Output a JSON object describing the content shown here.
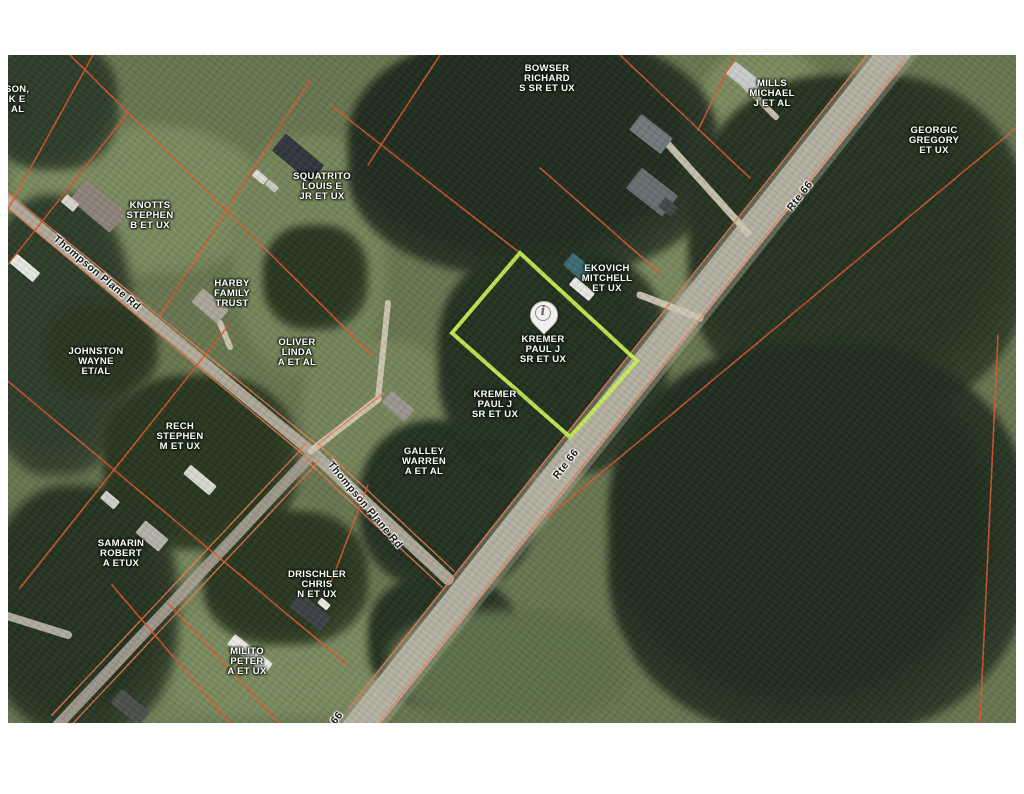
{
  "map": {
    "x": 8,
    "y": 55,
    "width": 1008,
    "height": 668,
    "colors": {
      "page_background": "#ffffff",
      "base_grass": "#67754f",
      "forest_dark": "#1f2c1e",
      "forest_mid": "#2c3b28",
      "lawn_light": "#7a8a5e",
      "parcel_line": "#e2572f",
      "road_edge_line": "#ef7a52",
      "highlight_outline": "#c6ed53",
      "road_fill": "#c6c1b4",
      "pin_fill": "#f2f0ec"
    },
    "owner_labels": [
      {
        "id": "johnson-partial",
        "lines": [
          "HNSON,",
          "ARK E",
          "ET AL"
        ],
        "x": 2,
        "y": 45
      },
      {
        "id": "knotts",
        "lines": [
          "KNOTTS",
          "STEPHEN",
          "B ET UX"
        ],
        "x": 142,
        "y": 161
      },
      {
        "id": "bowser",
        "lines": [
          "BOWSER",
          "RICHARD",
          "S SR ET UX"
        ],
        "x": 539,
        "y": 24
      },
      {
        "id": "mills",
        "lines": [
          "MILLS",
          "MICHAEL",
          "J ET AL"
        ],
        "x": 764,
        "y": 39
      },
      {
        "id": "georgic",
        "lines": [
          "GEORGIC",
          "GREGORY",
          "ET UX"
        ],
        "x": 926,
        "y": 86
      },
      {
        "id": "squatrito",
        "lines": [
          "SQUATRITO",
          "LOUIS E",
          "JR ET UX"
        ],
        "x": 314,
        "y": 132
      },
      {
        "id": "harby",
        "lines": [
          "HARBY",
          "FAMILY",
          "TRUST"
        ],
        "x": 224,
        "y": 239
      },
      {
        "id": "ekovich",
        "lines": [
          "EKOVICH",
          "MITCHELL",
          "ET UX"
        ],
        "x": 599,
        "y": 224
      },
      {
        "id": "kremer-pin",
        "lines": [
          "KREMER",
          "PAUL J",
          "SR ET UX"
        ],
        "x": 535,
        "y": 295
      },
      {
        "id": "kremer-2",
        "lines": [
          "KREMER",
          "PAUL J",
          "SR ET UX"
        ],
        "x": 487,
        "y": 350
      },
      {
        "id": "oliver",
        "lines": [
          "OLIVER",
          "LINDA",
          "A ET AL"
        ],
        "x": 289,
        "y": 298
      },
      {
        "id": "johnston",
        "lines": [
          "JOHNSTON",
          "WAYNE",
          "ET/AL"
        ],
        "x": 88,
        "y": 307
      },
      {
        "id": "rech",
        "lines": [
          "RECH",
          "STEPHEN",
          "M ET UX"
        ],
        "x": 172,
        "y": 382
      },
      {
        "id": "galley",
        "lines": [
          "GALLEY",
          "WARREN",
          "A ET AL"
        ],
        "x": 416,
        "y": 407
      },
      {
        "id": "samarin",
        "lines": [
          "SAMARIN",
          "ROBERT",
          "A ETUX"
        ],
        "x": 113,
        "y": 499
      },
      {
        "id": "drischler",
        "lines": [
          "DRISCHLER",
          "CHRIS",
          "N ET UX"
        ],
        "x": 309,
        "y": 530
      },
      {
        "id": "milito",
        "lines": [
          "MILITO",
          "PETER",
          "A ET UX"
        ],
        "x": 239,
        "y": 607
      }
    ],
    "road_labels": [
      {
        "id": "rte66-top",
        "text": "Rte 66",
        "x": 792,
        "y": 141,
        "rotation": -52
      },
      {
        "id": "rte66-mid",
        "text": "Rte 66",
        "x": 558,
        "y": 409,
        "rotation": -52
      },
      {
        "id": "rte66-partial",
        "text": "66",
        "x": 329,
        "y": 663,
        "rotation": -52
      },
      {
        "id": "thompson-plane-rd-1",
        "text": "Thompson Plane Rd",
        "x": 89,
        "y": 218,
        "rotation": 40
      },
      {
        "id": "thompson-plane-rd-2",
        "text": "Thompson Plane Rd",
        "x": 357,
        "y": 450,
        "rotation": 50
      }
    ],
    "highlight_parcel": {
      "owner": "KREMER PAUL J SR ET UX",
      "points": [
        [
          512,
          198
        ],
        [
          629,
          306
        ],
        [
          562,
          382
        ],
        [
          444,
          278
        ]
      ]
    },
    "pin": {
      "x": 535,
      "y": 277,
      "glyph": "i"
    },
    "roads": [
      {
        "id": "rte-66",
        "pts": [
          [
            904,
            -25
          ],
          [
            334,
            693
          ]
        ],
        "w": 30,
        "color": "#c6c1b4"
      },
      {
        "id": "rte-66-shoulder",
        "pts": [
          [
            904,
            -25
          ],
          [
            334,
            693
          ]
        ],
        "w": 40,
        "color": "#a9a593"
      },
      {
        "id": "thompson-upper",
        "pts": [
          [
            -10,
            138
          ],
          [
            305,
            398
          ]
        ],
        "w": 11,
        "color": "#b5ae9e"
      },
      {
        "id": "thompson-lower",
        "pts": [
          [
            305,
            398
          ],
          [
            440,
            524
          ]
        ],
        "w": 12,
        "color": "#b5ae9e"
      },
      {
        "id": "branch-southwest",
        "pts": [
          [
            305,
            398
          ],
          [
            50,
            670
          ]
        ],
        "w": 11,
        "color": "#a39d8f"
      },
      {
        "id": "stub-northeast",
        "pts": [
          [
            303,
            396
          ],
          [
            370,
            344
          ]
        ],
        "w": 7,
        "color": "#d0c8b4"
      },
      {
        "id": "oliver-driveway",
        "pts": [
          [
            370,
            344
          ],
          [
            380,
            248
          ]
        ],
        "w": 6,
        "color": "#d0c8b4"
      },
      {
        "id": "ekovich-driveway",
        "pts": [
          [
            632,
            240
          ],
          [
            692,
            263
          ]
        ],
        "w": 7,
        "color": "#d0c8b4"
      },
      {
        "id": "bowser-driveway",
        "pts": [
          [
            650,
            78
          ],
          [
            740,
            178
          ]
        ],
        "w": 7,
        "color": "#cfc7b2"
      },
      {
        "id": "mills-driveway",
        "pts": [
          [
            736,
            30
          ],
          [
            768,
            62
          ]
        ],
        "w": 6,
        "color": "#cfc7b2"
      },
      {
        "id": "harby-driveway",
        "pts": [
          [
            212,
            268
          ],
          [
            222,
            292
          ]
        ],
        "w": 6,
        "color": "#cfc7b2"
      },
      {
        "id": "west-spur",
        "pts": [
          [
            60,
            580
          ],
          [
            -10,
            558
          ]
        ],
        "w": 8,
        "color": "#b8b2a4"
      }
    ],
    "road_edge_lines": [
      [
        871,
        -15,
        341,
        653
      ],
      [
        897,
        5,
        367,
        673
      ],
      [
        -10,
        130,
        307,
        388
      ],
      [
        -6,
        148,
        303,
        406
      ],
      [
        311,
        390,
        446,
        516
      ],
      [
        299,
        406,
        434,
        532
      ],
      [
        299,
        388,
        44,
        660
      ],
      [
        311,
        406,
        56,
        678
      ],
      [
        309,
        390,
        376,
        338
      ]
    ],
    "parcel_lines": [
      [
        52,
        -10,
        364,
        300
      ],
      [
        85,
        0,
        -10,
        172
      ],
      [
        120,
        58,
        -10,
        222
      ],
      [
        302,
        25,
        152,
        260
      ],
      [
        221,
        270,
        12,
        533
      ],
      [
        -10,
        318,
        340,
        610
      ],
      [
        322,
        50,
        512,
        198
      ],
      [
        612,
        0,
        742,
        123
      ],
      [
        532,
        113,
        652,
        218
      ],
      [
        727,
        0,
        690,
        75
      ],
      [
        1008,
        73,
        540,
        462
      ],
      [
        990,
        280,
        972,
        668
      ],
      [
        432,
        0,
        360,
        110
      ],
      [
        360,
        430,
        322,
        530
      ],
      [
        160,
        548,
        275,
        672
      ],
      [
        104,
        530,
        222,
        668
      ]
    ],
    "buildings": [
      {
        "id": "knotts-house",
        "cx": 90,
        "cy": 151,
        "w": 52,
        "h": 26,
        "rot": 40,
        "color": "#8f837b"
      },
      {
        "id": "knotts-pad",
        "cx": 62,
        "cy": 148,
        "w": 16,
        "h": 10,
        "rot": 40,
        "color": "#d8d5cc"
      },
      {
        "id": "squatrito-house",
        "cx": 290,
        "cy": 103,
        "w": 50,
        "h": 22,
        "rot": 40,
        "color": "#30353b"
      },
      {
        "id": "squatrito-car-1",
        "cx": 252,
        "cy": 122,
        "w": 15,
        "h": 8,
        "rot": 40,
        "color": "#dddcd6"
      },
      {
        "id": "squatrito-car-2",
        "cx": 264,
        "cy": 131,
        "w": 13,
        "h": 7,
        "rot": 40,
        "color": "#c9c9c3"
      },
      {
        "id": "bowser-house-1",
        "cx": 643,
        "cy": 79,
        "w": 40,
        "h": 20,
        "rot": 38,
        "color": "#70787a"
      },
      {
        "id": "bowser-house-2",
        "cx": 644,
        "cy": 137,
        "w": 46,
        "h": 26,
        "rot": 38,
        "color": "#666d70"
      },
      {
        "id": "bowser-house-2-wing",
        "cx": 660,
        "cy": 152,
        "w": 16,
        "h": 12,
        "rot": 38,
        "color": "#3f4649"
      },
      {
        "id": "mills-house",
        "cx": 736,
        "cy": 23,
        "w": 34,
        "h": 16,
        "rot": 38,
        "color": "#c9ccca"
      },
      {
        "id": "ekovich-house",
        "cx": 570,
        "cy": 212,
        "w": 26,
        "h": 16,
        "rot": 40,
        "color": "#3c6a72"
      },
      {
        "id": "ekovich-trailer",
        "cx": 574,
        "cy": 234,
        "w": 26,
        "h": 10,
        "rot": 40,
        "color": "#e9e9e5"
      },
      {
        "id": "oliver-house",
        "cx": 390,
        "cy": 351,
        "w": 30,
        "h": 16,
        "rot": 40,
        "color": "#9b978f"
      },
      {
        "id": "harby-house",
        "cx": 202,
        "cy": 251,
        "w": 34,
        "h": 18,
        "rot": 40,
        "color": "#aba59b"
      },
      {
        "id": "johnston-trailer",
        "cx": 17,
        "cy": 213,
        "w": 30,
        "h": 12,
        "rot": 40,
        "color": "#e7e7e3"
      },
      {
        "id": "rech-mobile-home",
        "cx": 192,
        "cy": 425,
        "w": 34,
        "h": 12,
        "rot": 40,
        "color": "#d9d9d3"
      },
      {
        "id": "shed",
        "cx": 102,
        "cy": 445,
        "w": 18,
        "h": 10,
        "rot": 40,
        "color": "#d0d0c9"
      },
      {
        "id": "samarin-house",
        "cx": 144,
        "cy": 481,
        "w": 30,
        "h": 16,
        "rot": 40,
        "color": "#b7b3a9"
      },
      {
        "id": "drischler-house",
        "cx": 302,
        "cy": 557,
        "w": 40,
        "h": 18,
        "rot": 40,
        "color": "#3b4042"
      },
      {
        "id": "drischler-house-white",
        "cx": 316,
        "cy": 549,
        "w": 12,
        "h": 7,
        "rot": 40,
        "color": "#eaeae6"
      },
      {
        "id": "milito-trailer",
        "cx": 242,
        "cy": 599,
        "w": 48,
        "h": 13,
        "rot": 38,
        "color": "#edece6"
      },
      {
        "id": "southwest-house",
        "cx": 122,
        "cy": 652,
        "w": 36,
        "h": 18,
        "rot": 40,
        "color": "#4b4f4b"
      }
    ],
    "terrain": [
      {
        "id": "lawn-knotts",
        "x": 0,
        "y": 70,
        "w": 255,
        "h": 150,
        "color": "#7a8a5e",
        "blur": 5
      },
      {
        "id": "lawn-squatrito-harby",
        "x": 225,
        "y": 80,
        "w": 155,
        "h": 240,
        "color": "#75855a",
        "blur": 5
      },
      {
        "id": "lawn-bowser-east",
        "x": 565,
        "y": 25,
        "w": 130,
        "h": 170,
        "color": "#7a8a5e",
        "blur": 5
      },
      {
        "id": "lawn-roadside-ne",
        "x": 630,
        "y": 120,
        "w": 130,
        "h": 150,
        "color": "#75855a",
        "blur": 5
      },
      {
        "id": "lawn-mills",
        "x": 692,
        "y": -5,
        "w": 130,
        "h": 115,
        "color": "#7a8a5e",
        "blur": 5
      },
      {
        "id": "lawn-oliver",
        "x": 295,
        "y": 285,
        "w": 150,
        "h": 135,
        "color": "#75855a",
        "blur": 5
      },
      {
        "id": "lawn-ekovich",
        "x": 545,
        "y": 135,
        "w": 140,
        "h": 115,
        "color": "#78885c",
        "blur": 5
      },
      {
        "id": "field-southwest",
        "x": 0,
        "y": 420,
        "w": 340,
        "h": 250,
        "color": "#74855c",
        "blur": 6
      },
      {
        "id": "field-milito",
        "x": 150,
        "y": 545,
        "w": 265,
        "h": 120,
        "color": "#7a8a5e",
        "blur": 6
      },
      {
        "id": "forest-top-center",
        "x": 340,
        "y": -20,
        "w": 370,
        "h": 240,
        "color": "#1f2c1e",
        "blur": 4
      },
      {
        "id": "forest-right-upper",
        "x": 680,
        "y": 20,
        "w": 340,
        "h": 340,
        "color": "#24321f",
        "blur": 4
      },
      {
        "id": "forest-right-lower",
        "x": 600,
        "y": 290,
        "w": 420,
        "h": 390,
        "color": "#1f2c1e",
        "blur": 4
      },
      {
        "id": "forest-galley",
        "x": 352,
        "y": 365,
        "w": 175,
        "h": 170,
        "color": "#22301f",
        "blur": 4
      },
      {
        "id": "forest-kremer",
        "x": 430,
        "y": 190,
        "w": 230,
        "h": 230,
        "color": "#22301f",
        "blur": 4
      },
      {
        "id": "forest-topleft-corner",
        "x": -20,
        "y": -15,
        "w": 130,
        "h": 130,
        "color": "#2c3b28",
        "blur": 4
      },
      {
        "id": "forest-left-band",
        "x": -25,
        "y": 140,
        "w": 150,
        "h": 280,
        "color": "#2c3b28",
        "blur": 5
      },
      {
        "id": "forest-johnston",
        "x": 40,
        "y": 250,
        "w": 110,
        "h": 90,
        "color": "#28361f",
        "blur": 4
      },
      {
        "id": "forest-rech",
        "x": 95,
        "y": 320,
        "w": 195,
        "h": 175,
        "color": "#28361f",
        "blur": 4
      },
      {
        "id": "forest-bottomleft",
        "x": -20,
        "y": 430,
        "w": 190,
        "h": 250,
        "color": "#24321f",
        "blur": 5
      },
      {
        "id": "forest-drischler-west",
        "x": 195,
        "y": 455,
        "w": 165,
        "h": 135,
        "color": "#28361f",
        "blur": 4
      },
      {
        "id": "forest-squatrito-south",
        "x": 255,
        "y": 170,
        "w": 105,
        "h": 105,
        "color": "#28361f",
        "blur": 4
      },
      {
        "id": "forest-branch-south",
        "x": 360,
        "y": 520,
        "w": 150,
        "h": 130,
        "color": "#22301f",
        "blur": 4
      },
      {
        "id": "field-road-southeast",
        "x": 380,
        "y": 555,
        "w": 240,
        "h": 113,
        "color": "#5e6f4b",
        "blur": 6
      }
    ]
  }
}
